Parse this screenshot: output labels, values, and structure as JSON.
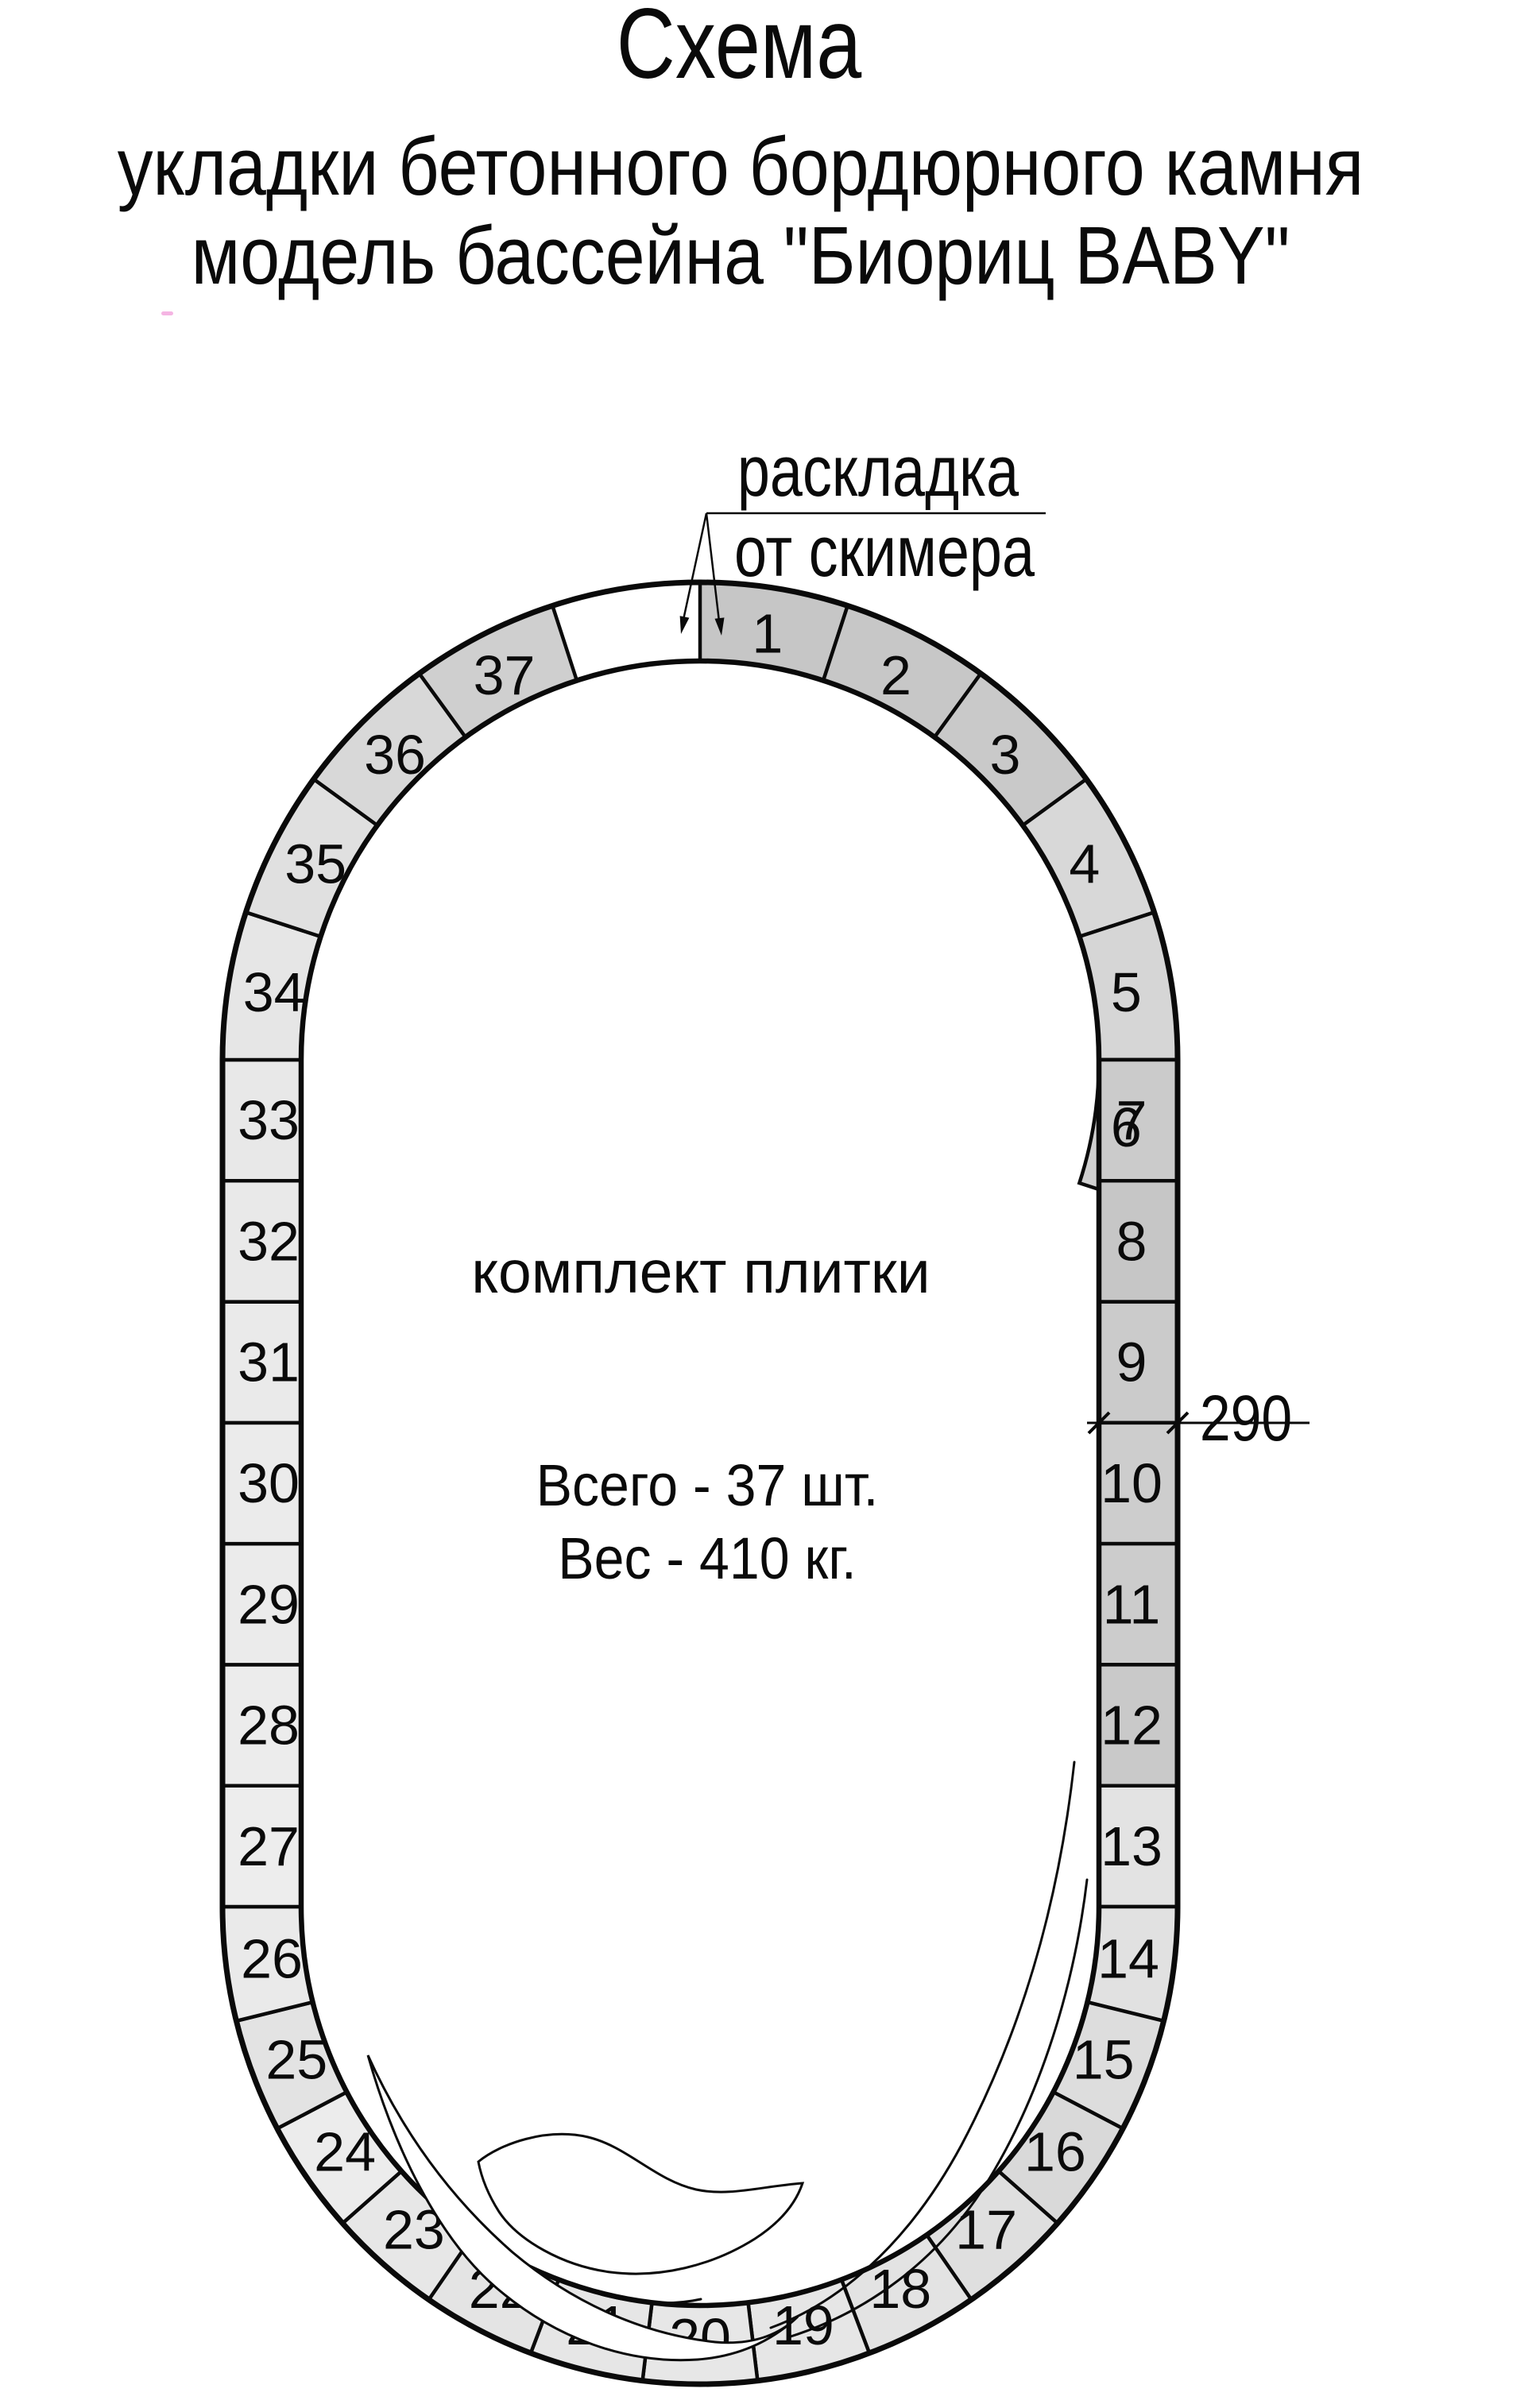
{
  "page": {
    "title": "Схема",
    "subtitle_line1": "укладки бетонного бордюрного камня",
    "subtitle_line2": "модель бассейна \"Биориц BABY\"",
    "ink_color": "#0a0a0a",
    "background_color": "#ffffff"
  },
  "callout": {
    "line1": "раскладка",
    "line2": "от скимера"
  },
  "interior_text": {
    "set_label": "комплект плитки",
    "total_line": "Всего - 37 шт.",
    "weight_line": "Вес - 410 кг."
  },
  "dimension": {
    "value": "290"
  },
  "ring": {
    "segment_count": 37,
    "segments": [
      {
        "n": 1,
        "fill": "#c6c6c6"
      },
      {
        "n": 2,
        "fill": "#c7c7c7"
      },
      {
        "n": 3,
        "fill": "#c9c9c9"
      },
      {
        "n": 4,
        "fill": "#d8d8d8"
      },
      {
        "n": 5,
        "fill": "#d6d6d6"
      },
      {
        "n": 6,
        "fill": "#d0d0d0"
      },
      {
        "n": 7,
        "fill": "#cbcbcb"
      },
      {
        "n": 8,
        "fill": "#c6c6c6"
      },
      {
        "n": 9,
        "fill": "#cbcbcb"
      },
      {
        "n": 10,
        "fill": "#cdcdcd"
      },
      {
        "n": 11,
        "fill": "#cccccc"
      },
      {
        "n": 12,
        "fill": "#c9c9c9"
      },
      {
        "n": 13,
        "fill": "#e3e3e3"
      },
      {
        "n": 14,
        "fill": "#e1e1e1"
      },
      {
        "n": 15,
        "fill": "#dddddd"
      },
      {
        "n": 16,
        "fill": "#d9d9d9"
      },
      {
        "n": 17,
        "fill": "#dfdfdf"
      },
      {
        "n": 18,
        "fill": "#e3e3e3"
      },
      {
        "n": 19,
        "fill": "#e6e6e6"
      },
      {
        "n": 20,
        "fill": "#e7e7e7"
      },
      {
        "n": 21,
        "fill": "#e6e6e6"
      },
      {
        "n": 22,
        "fill": "#e4e4e4"
      },
      {
        "n": 23,
        "fill": "#e7e7e7"
      },
      {
        "n": 24,
        "fill": "#ececec"
      },
      {
        "n": 25,
        "fill": "#e3e3e3"
      },
      {
        "n": 26,
        "fill": "#eaeaea"
      },
      {
        "n": 27,
        "fill": "#ededed"
      },
      {
        "n": 28,
        "fill": "#ececec"
      },
      {
        "n": 29,
        "fill": "#ebebeb"
      },
      {
        "n": 30,
        "fill": "#ebebeb"
      },
      {
        "n": 31,
        "fill": "#eaeaea"
      },
      {
        "n": 32,
        "fill": "#e9e9e9"
      },
      {
        "n": 33,
        "fill": "#e8e8e8"
      },
      {
        "n": 34,
        "fill": "#e6e6e6"
      },
      {
        "n": 35,
        "fill": "#e0e0e0"
      },
      {
        "n": 36,
        "fill": "#d8d8d8"
      },
      {
        "n": 37,
        "fill": "#cfcfcf"
      }
    ]
  }
}
